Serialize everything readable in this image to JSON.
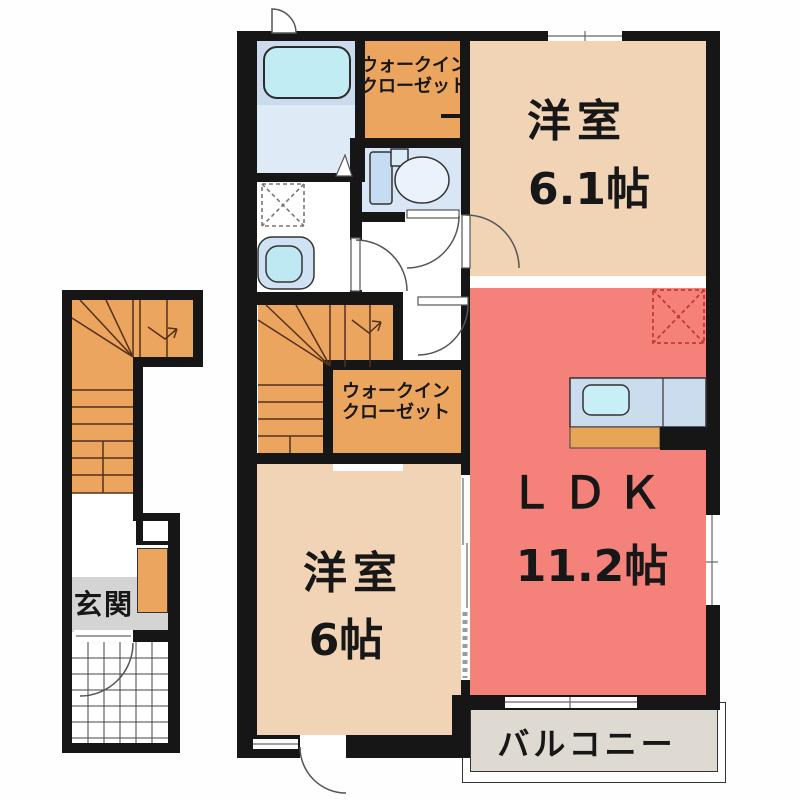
{
  "floor_plan": {
    "rooms": {
      "western_room_1": {
        "name": "洋室",
        "size": "6.1帖"
      },
      "ldk": {
        "name": "ＬＤＫ",
        "size": "11.2帖"
      },
      "western_room_2": {
        "name": "洋室",
        "size": "6帖"
      },
      "walk_in_closet_1": {
        "line1": "ウォークイン",
        "line2": "クローゼット"
      },
      "walk_in_closet_2": {
        "line1": "ウォークイン",
        "line2": "クローゼット"
      },
      "entrance": {
        "name": "玄関"
      },
      "balcony": {
        "name": "バルコニー"
      }
    },
    "colors": {
      "wall": "#161616",
      "western_room": "#f1d3b5",
      "ldk": "#f5817b",
      "closet_and_stairs": "#eba55e",
      "bathroom": "#ccdaee",
      "bathroom_floor": "#dfeaf7",
      "toilet_room": "#d8e6f6",
      "entrance_floor": "#d4d4d4",
      "balcony_floor": "#ded9d1",
      "water_fixture": "#c2ecf4"
    }
  }
}
